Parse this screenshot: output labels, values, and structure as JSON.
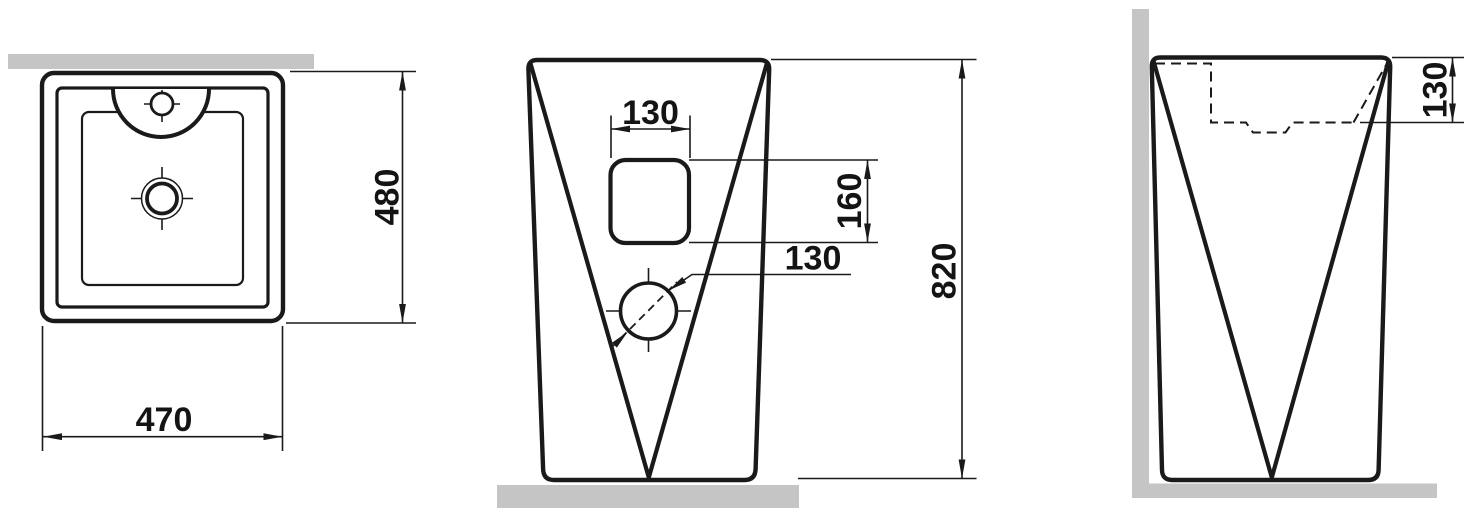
{
  "document": {
    "type": "technical-dimension-drawing",
    "subject": "pedestal-washbasin-three-views"
  },
  "colors": {
    "line": "#1a1a1a",
    "wall_fill": "#c5c5c5",
    "background": "#ffffff"
  },
  "views": {
    "top": {
      "width_label": "470",
      "depth_label": "480"
    },
    "front": {
      "hole_width_label": "130",
      "hole_height_label": "160",
      "hole_diameter_label": "130",
      "overall_height_label": "820"
    },
    "side": {
      "basin_depth_label": "130"
    }
  }
}
